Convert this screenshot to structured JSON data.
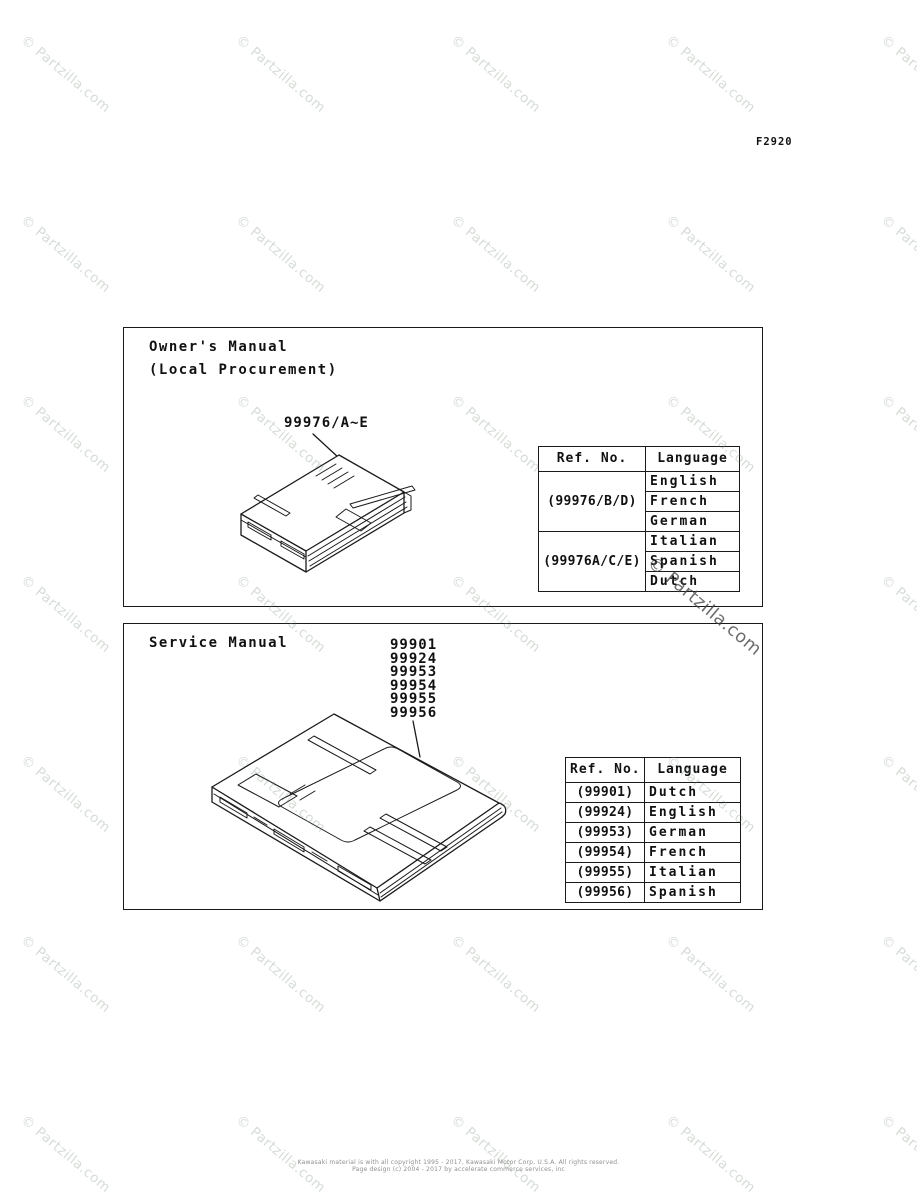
{
  "page": {
    "figure_code": "F2920",
    "watermark_text": "© Partzilla.com",
    "footer_line1": "Kawasaki material is with all copyright 1995 - 2017, Kawasaki Motor Corp, U.S.A. All rights reserved.",
    "footer_line2": "Page design (c) 2004 - 2017 by accelerate commerce services, inc"
  },
  "owners_manual": {
    "title": "Owner's Manual",
    "subtitle": "(Local Procurement)",
    "part_label": "99976/A~E",
    "table": {
      "headers": [
        "Ref. No.",
        "Language"
      ],
      "groups": [
        {
          "ref": "(99976/B/D)",
          "languages": [
            "English",
            "French",
            "German"
          ]
        },
        {
          "ref": "(99976A/C/E)",
          "languages": [
            "Italian",
            "Spanish",
            "Dutch"
          ]
        }
      ]
    }
  },
  "service_manual": {
    "title": "Service Manual",
    "part_numbers": [
      "99901",
      "99924",
      "99953",
      "99954",
      "99955",
      "99956"
    ],
    "table": {
      "headers": [
        "Ref. No.",
        "Language"
      ],
      "rows": [
        {
          "ref": "(99901)",
          "language": "Dutch"
        },
        {
          "ref": "(99924)",
          "language": "English"
        },
        {
          "ref": "(99953)",
          "language": "German"
        },
        {
          "ref": "(99954)",
          "language": "French"
        },
        {
          "ref": "(99955)",
          "language": "Italian"
        },
        {
          "ref": "(99956)",
          "language": "Spanish"
        }
      ]
    }
  }
}
